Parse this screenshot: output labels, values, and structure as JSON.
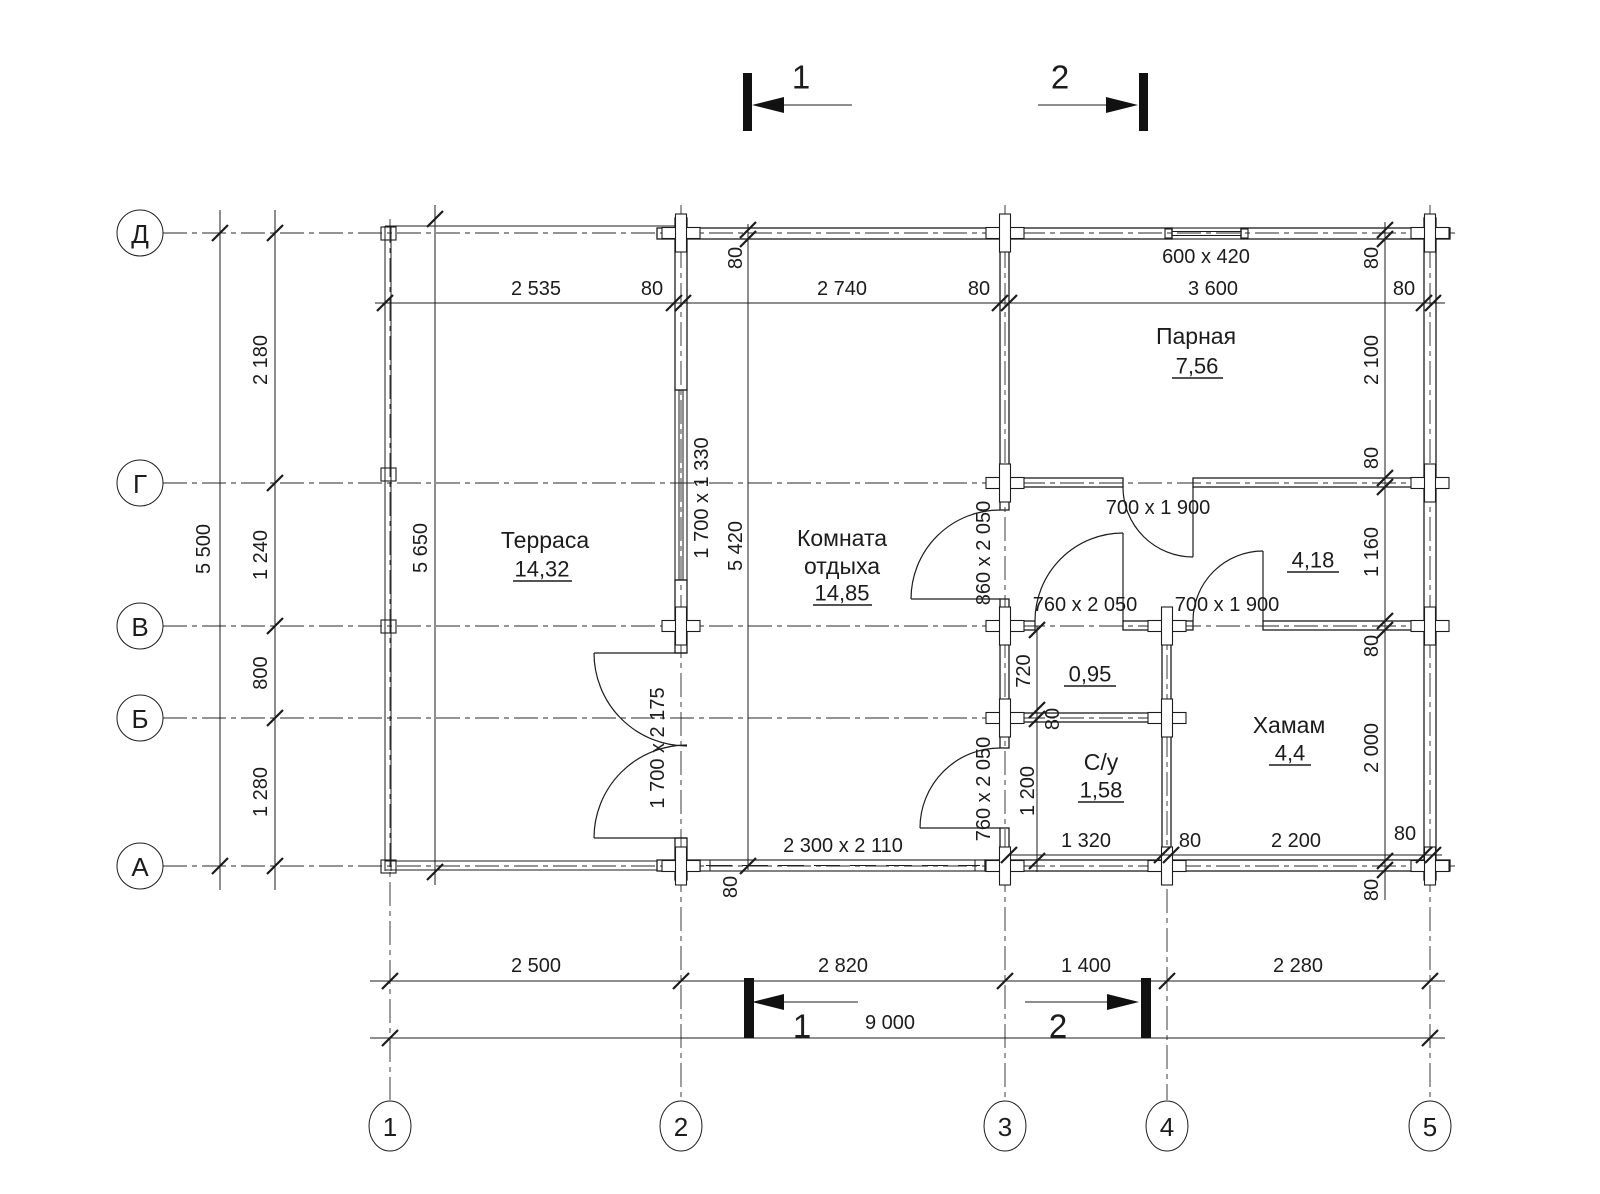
{
  "colors": {
    "ink": "#1c1c1c",
    "post": "#f2c38f"
  },
  "axes": {
    "rows": [
      "Д",
      "Г",
      "В",
      "Б",
      "А"
    ],
    "cols": [
      "1",
      "2",
      "3",
      "4",
      "5"
    ]
  },
  "sections": {
    "s1": "1",
    "s2": "2"
  },
  "rooms": {
    "terrace": {
      "name": "Терраса",
      "area": "14,32"
    },
    "lounge": {
      "name_line1": "Комната",
      "name_line2": "отдыха",
      "area": "14,85"
    },
    "steam": {
      "name": "Парная",
      "area": "7,56"
    },
    "hall": {
      "area": "4,18"
    },
    "cell": {
      "area": "0,95"
    },
    "wc": {
      "name": "С/у",
      "area": "1,58"
    },
    "hammam": {
      "name": "Хамам",
      "area": "4,4"
    }
  },
  "dims": {
    "left_total": "5 500",
    "left": [
      "2 180",
      "1 240",
      "800",
      "1 280"
    ],
    "top": [
      "2 535",
      "80",
      "2 740",
      "80",
      "3 600",
      "80"
    ],
    "right": [
      "80",
      "2 100",
      "80",
      "1 160",
      "80",
      "2 000",
      "80"
    ],
    "bottom": [
      "2 500",
      "2 820",
      "1 400",
      "2 280"
    ],
    "bottom_total": "9 000",
    "terrace_depth": "5 650",
    "lounge_depth": "5 420",
    "lounge_top_wall": "80",
    "lounge_bottom_wall": "80",
    "wc_chain": [
      "720",
      "80",
      "1 200"
    ],
    "bottom_inner": [
      "1 320",
      "80",
      "2 200",
      "80"
    ]
  },
  "openings": {
    "top_window": "600 x 420",
    "left_window": "1 700 x 1 330",
    "terrace_door": "1 700 x 2 175",
    "patio_door": "2 300 x 2 110",
    "hall_door": "860 x 2 050",
    "wc_door": "760 x 2 050",
    "small_door": "760 x 2 050",
    "steam_door": "700 x 1 900",
    "hammam_door": "700 x 1 900"
  }
}
